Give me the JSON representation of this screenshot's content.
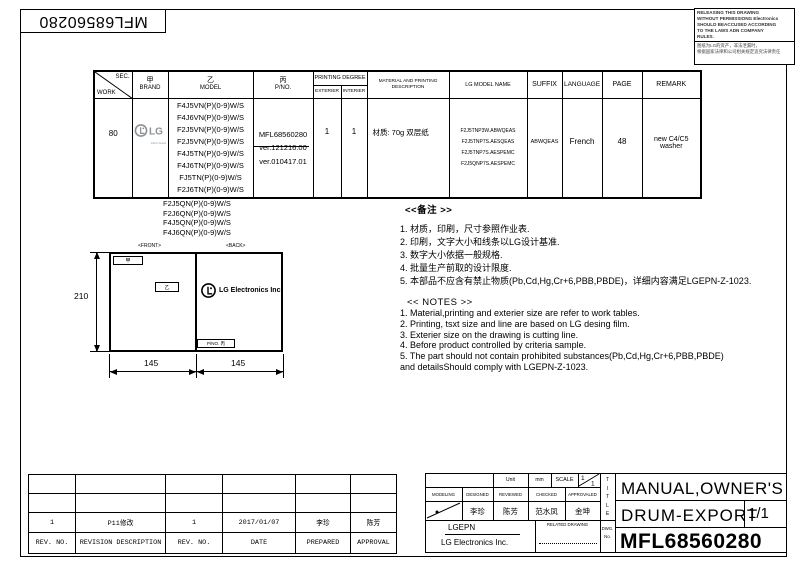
{
  "rotated_part_no": "MFL68560280",
  "notice": {
    "en_lines": [
      "RELEASING THIS DRAWING",
      "WITHOUT PERMISSIONG Electronics",
      "SHOULD BEACCUSED ACCORDING",
      "TO THE LAWS ADN COMPANY",
      "RULES."
    ],
    "cn_lines": [
      "图纸为LG的资产，非法泄漏时，",
      "根据国家法律和公司相关规定追究法律责任"
    ]
  },
  "main_table": {
    "headers": {
      "sec": "SEC.",
      "work": "WORK",
      "brand_cn": "甲",
      "brand_en": "BRAND",
      "model_cn": "乙",
      "model_en": "MODEL",
      "pno_cn": "丙",
      "pno_en": "P/NO.",
      "printing_degree": "PRINTING DEGREE",
      "exterier": "EXTERIER",
      "interier": "INTERIER",
      "material": "MATERIAL AND PRINTING DESCRIPTION",
      "lg_model_name": "LG MODEL NAME",
      "suffix": "SUFFIX",
      "language": "LANGUAGE",
      "page": "PAGE",
      "remark": "REMARK"
    },
    "row": {
      "sec_work": "80",
      "brand_logo": "LG",
      "brand_tagline": "Life's Good",
      "models": [
        "F4J5VN(P)(0-9)W/S",
        "F4J6VN(P)(0-9)W/S",
        "F2J5VN(P)(0-9)W/S",
        "F2J5VN(P)(0-9)W/S",
        "F4J5TN(P)(0-9)W/S",
        "F4J6TN(P)(0-9)W/S",
        "FJ5TN(P)(0-9)W/S",
        "F2J6TN(P)(0-9)W/S"
      ],
      "pno_part": "MFL68560280",
      "pno_old_ver": "ver.121216.00",
      "pno_new_ver": "ver.010417.01",
      "exterier": "1",
      "interier": "1",
      "material": "材质: 70g 双层纸",
      "lg_model_names": [
        "F2J5TNP3W.ABWQEAS",
        "F2J5TNP7S.AESQEAS",
        "F2J5TNP7S.AESPEMC",
        "F2J5QNP7S.AESPEMC"
      ],
      "suffix": "ABWQEAS",
      "language": "French",
      "page": "48",
      "remark_line1": "new C4/C5",
      "remark_line2": "washer"
    },
    "extra_models": [
      "F2J5QN(P)(0-9)W/S",
      "F2J6QN(P)(0-9)W/S",
      "F4J5QN(P)(0-9)W/S",
      "F4J6QN(P)(0-9)W/S"
    ]
  },
  "drawing": {
    "front_label": "<FRONT>",
    "back_label": "<BACK>",
    "jia": "甲",
    "yi": "乙",
    "logo_text": "LG Electronics Inc.",
    "pno_label": "P/NO. 丙",
    "dim_height": "210",
    "dim_width_left": "145",
    "dim_width_right": "145"
  },
  "notes_cn": {
    "title": "<<备注 >>",
    "items": [
      "1.  材质，印刷，尺寸参照作业表.",
      "2.  印刷，文字大小和线条以LG设计基准.",
      "3.  数字大小依据一般规格.",
      "4.  批量生产前取的设计限度.",
      "5.  本部品不应含有禁止物质(Pb,Cd,Hg,Cr+6,PBB,PBDE)，详细内容满足LGEPN-Z-1023."
    ]
  },
  "notes_en": {
    "title": "<< NOTES >>",
    "items": [
      "1. Material,printing and exterier size are refer to work tables.",
      "2. Printing, tsxt  size and line are based on LG desing film.",
      "3. Exterier size on the drawing is cutting line.",
      "4. Before product controlled by criteria sample.",
      "5. The part should not contain prohibited substances(Pb,Cd,Hg,Cr+6,PBB,PBDE)",
      "    and detailsShould comply with LGEPN-Z-1023."
    ]
  },
  "revision_table": {
    "headers": [
      "REV. NO.",
      "REVISION DESCRIPTION",
      "REV. NO.",
      "DATE",
      "PREPARED",
      "APPROVAL"
    ],
    "row": [
      "1",
      "P11修改",
      "1",
      "2017/01/07",
      "李珍",
      "陈芳"
    ]
  },
  "title_block": {
    "unit_label": "Unit",
    "unit_value": "mm",
    "scale_label": "SCALE",
    "scale_numerator": "1",
    "scale_denominator": "1",
    "col_labels": [
      "MODELING",
      "DESIGNED",
      "REVIEWED",
      "CHECKED",
      "APPROVALED"
    ],
    "names": [
      "李珍",
      "陈芳",
      "范水凤",
      "金坤"
    ],
    "company_short": "LGEPN",
    "company_full": "LG Electronics Inc.",
    "related_drawing": "RELATED DRAWING",
    "title_letters": [
      "T",
      "I",
      "T",
      "L",
      "E"
    ],
    "dwg": "DWG.",
    "no": "No.",
    "title_line1": "MANUAL,OWNER'S",
    "title_line2": "DRUM-EXPORT",
    "sheet": "1/1",
    "part_no": "MFL68560280"
  }
}
